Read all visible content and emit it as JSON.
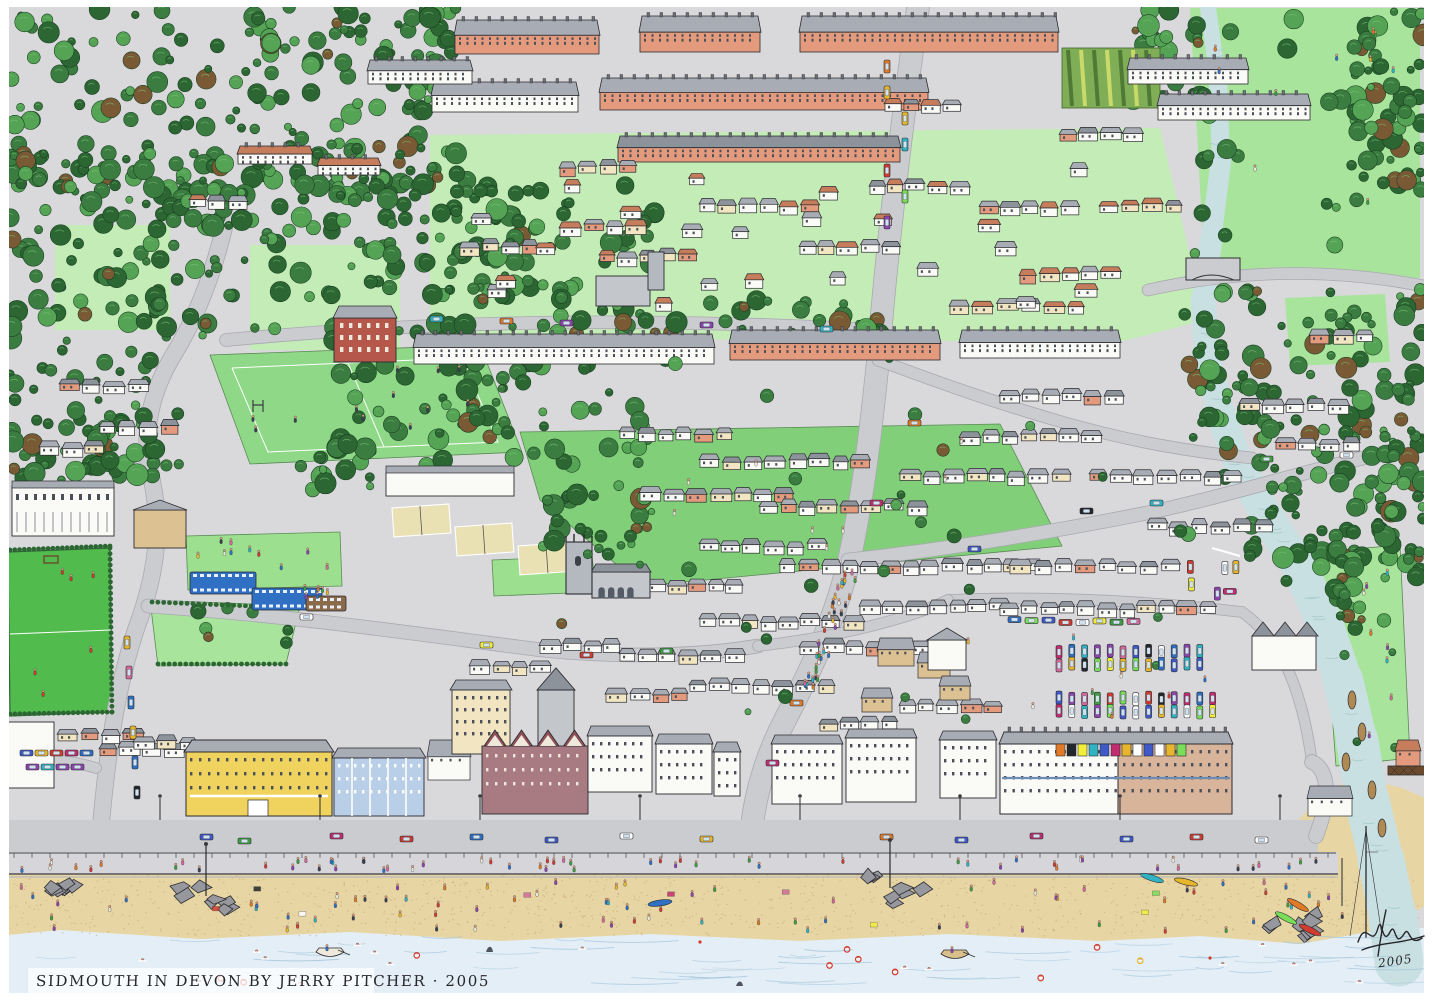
{
  "artwork": {
    "caption": "SIDMOUTH IN DEVON BY JERRY PITCHER · 2005",
    "signature_year": "2005"
  },
  "palette": {
    "paper": "#ffffff",
    "ink": "#2b2b30",
    "ground": "#d9d9dc",
    "road": "#cbccd0",
    "promenade": "#d6d6da",
    "woodland": "#2c6633",
    "tree_mid": "#3b7d40",
    "tree_light": "#55a355",
    "tree_copper": "#7a5a34",
    "clearing": "#c4ecb6",
    "park": "#a9e49c",
    "field": "#82cf7a",
    "pitch": "#8ed887",
    "lawn": "#9ce08f",
    "football": "#52bb4e",
    "river": "#c9e0e2",
    "sea": "#e4eef6",
    "wave": "#9fc3da",
    "sand": "#e7d6a4",
    "pebble": "#c2996b",
    "rock": "#97989d",
    "roof_grey": "#a8adb5",
    "roof_dark": "#8d939b",
    "roof_red": "#c57d5c",
    "wall_white": "#fafaf6",
    "wall_cream": "#f1e5c2",
    "wall_salmon": "#e49b7d",
    "wall_brick": "#b5574b",
    "wall_tan": "#dcc193",
    "hotel_yellow": "#f0d35e",
    "terrace_blue": "#b8cfe7",
    "maroon": "#a87a82",
    "court": "#e9e0b4",
    "car_colors": [
      "#d23b2f",
      "#2f6fc4",
      "#e8b62c",
      "#3f9e3f",
      "#e07a26",
      "#8e44ad",
      "#31b3c4",
      "#d46a9a",
      "#f2ef3a",
      "#7adf58",
      "#4059c8",
      "#c22d6f",
      "#23262b",
      "#ffffff"
    ],
    "people_colors": [
      "#d23b2f",
      "#e07a26",
      "#e8b62c",
      "#3f9e3f",
      "#2f6fc4",
      "#d46a9a",
      "#8e44ad",
      "#31b3c4",
      "#ece8da",
      "#394050"
    ]
  }
}
